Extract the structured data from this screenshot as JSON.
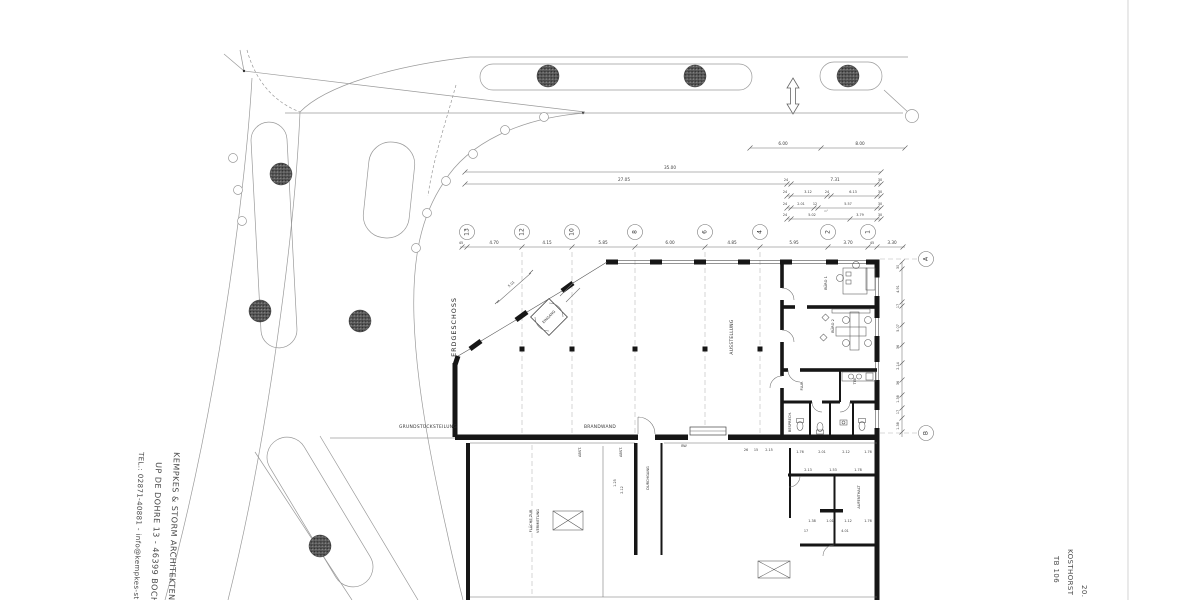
{
  "titleblock": {
    "architect": "KEMPKES & STORM   ARCHITEKTEN",
    "address": "UP DE DOHRE 13   -   46399 BOCHOLT",
    "contact": "TEL.: 02871-40881 - info@kempkes-sto",
    "project": "KOSTHORST",
    "sheet": "TB 106",
    "sheet_no": "20."
  },
  "plan_labels": {
    "floor": "ERDGESCHOSS",
    "hall": "AUSSTELLUNG",
    "entrance": "EINGANG",
    "office1": "BÜRO 1",
    "office2": "BÜRO 2",
    "corridor": "FLUR",
    "tea": "TEE",
    "meeting": "BESPRECH.",
    "lounge": "AUFENTHALT",
    "passage": "DURCHGANG",
    "storage1": "ABST.",
    "storage2": "ABST.",
    "rental1": "FLÄCHE ZUR",
    "rental2": "VERMIETUNG",
    "firewall": "BRANDWAND",
    "site_division": "GRUNDSTÜCKSTEILUNG",
    "bw": "BW"
  },
  "grid": {
    "columns": [
      "13",
      "12",
      "10",
      "8",
      "6",
      "4",
      "2",
      "1"
    ],
    "rows": [
      "A",
      "B"
    ],
    "spacings": [
      "45",
      "4.70",
      "4.15",
      "5.85",
      "6.00",
      "4.85",
      "5.95",
      "3.70",
      "45",
      "3.30"
    ]
  },
  "dimensions": {
    "overall": "35.00",
    "sub": "27.05",
    "road_a": "6.00",
    "road_b": "8.00",
    "top_r1": [
      "24",
      "7.31",
      "30"
    ],
    "top_r2": [
      "24",
      "3.12",
      "24",
      "6.13",
      "30"
    ],
    "top_r3": [
      "24",
      "2.01",
      "12",
      "5.57",
      "30"
    ],
    "top_r4": [
      "24",
      "5.02",
      "3.79",
      "30"
    ],
    "top_r4_note": "m²",
    "right_chain": [
      "30",
      "4.91",
      "17",
      "5.07",
      "36",
      "2.14",
      "36",
      "1.38",
      "17",
      "1.38"
    ],
    "entrance": "5.01",
    "wc_row1": [
      "1.76",
      "2.01",
      "2.12",
      "1.76"
    ],
    "wc_row2": [
      "2.13",
      "1.53",
      "1.78"
    ],
    "wc_row3": [
      "1.38",
      "1.01",
      "1.12",
      "1.76"
    ],
    "wc_row4": [
      "17",
      "4.01"
    ],
    "door_note": [
      "26",
      "15",
      "2.15"
    ],
    "passage": [
      "1.25",
      "2.12"
    ]
  }
}
